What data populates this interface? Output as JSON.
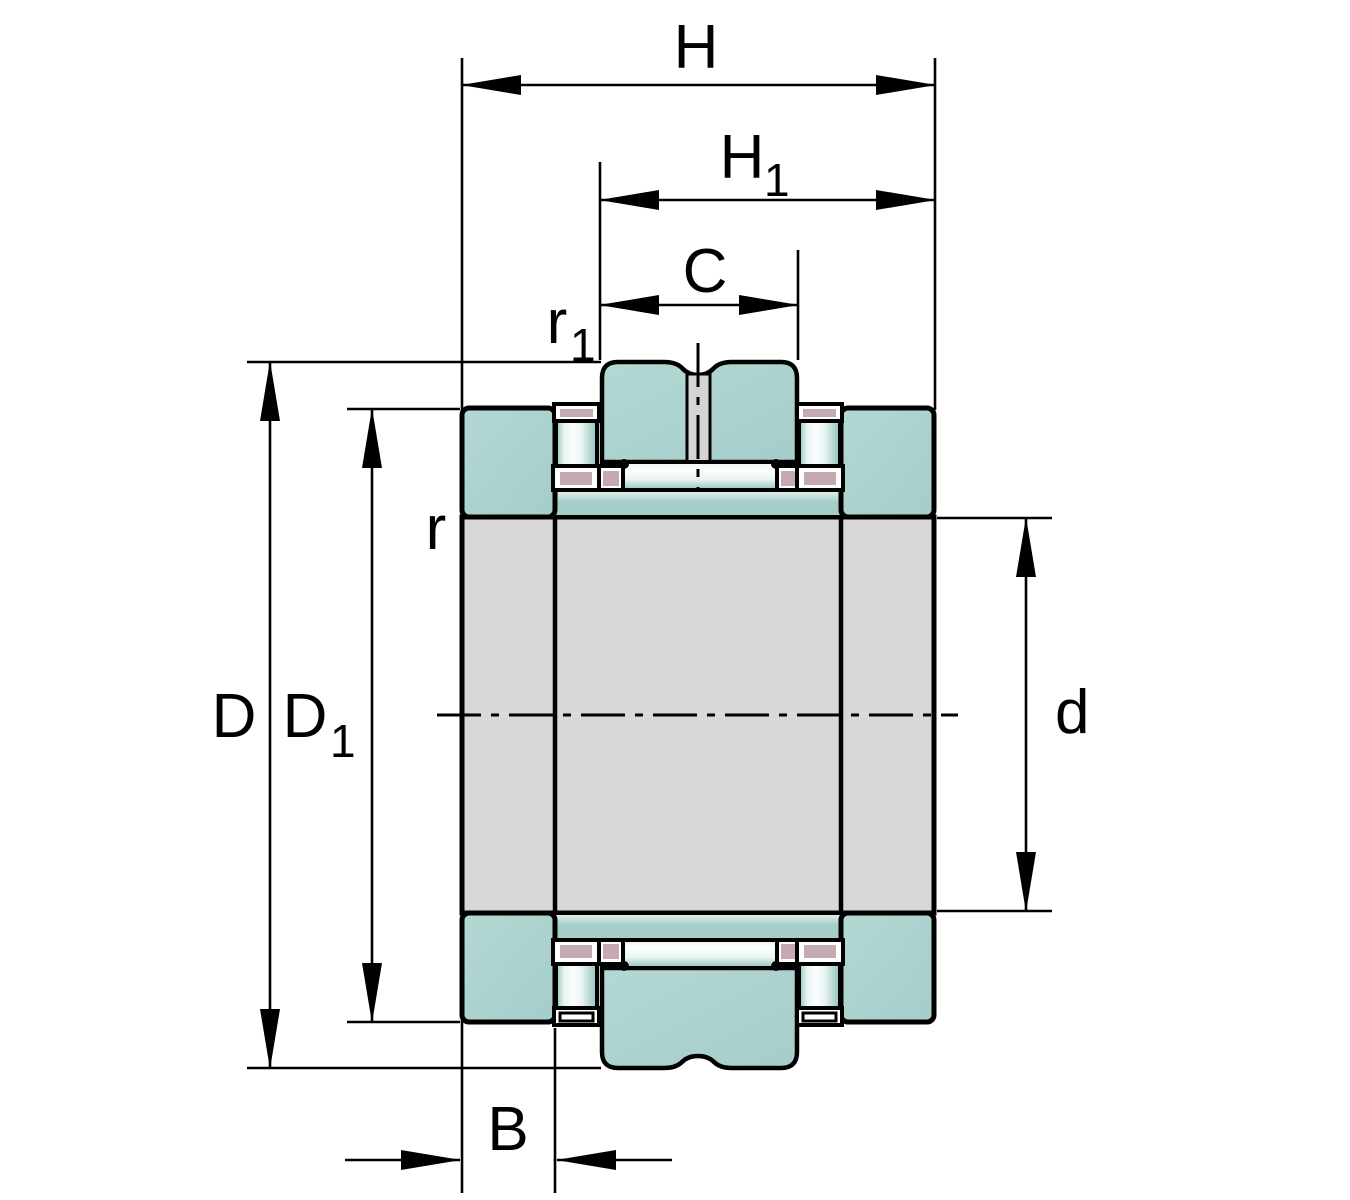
{
  "diagram": {
    "type": "bearing-cross-section",
    "labels": {
      "H": "H",
      "H1": {
        "base": "H",
        "sub": "1"
      },
      "C": "C",
      "r1": {
        "base": "r",
        "sub": "1"
      },
      "r": "r",
      "D": "D",
      "D1": {
        "base": "D",
        "sub": "1"
      },
      "d": "d",
      "B": "B"
    },
    "colors": {
      "outline": "#000000",
      "teal": "#a5cdca",
      "teal_highlight": "#e9f4f3",
      "gray": "#d8d8d8",
      "channel_gray": "#d4d4d4",
      "pink": "#c5a9b1",
      "roller_light": "#fbfffe",
      "roller_edge": "#8fc2bd",
      "background": "#ffffff"
    }
  }
}
